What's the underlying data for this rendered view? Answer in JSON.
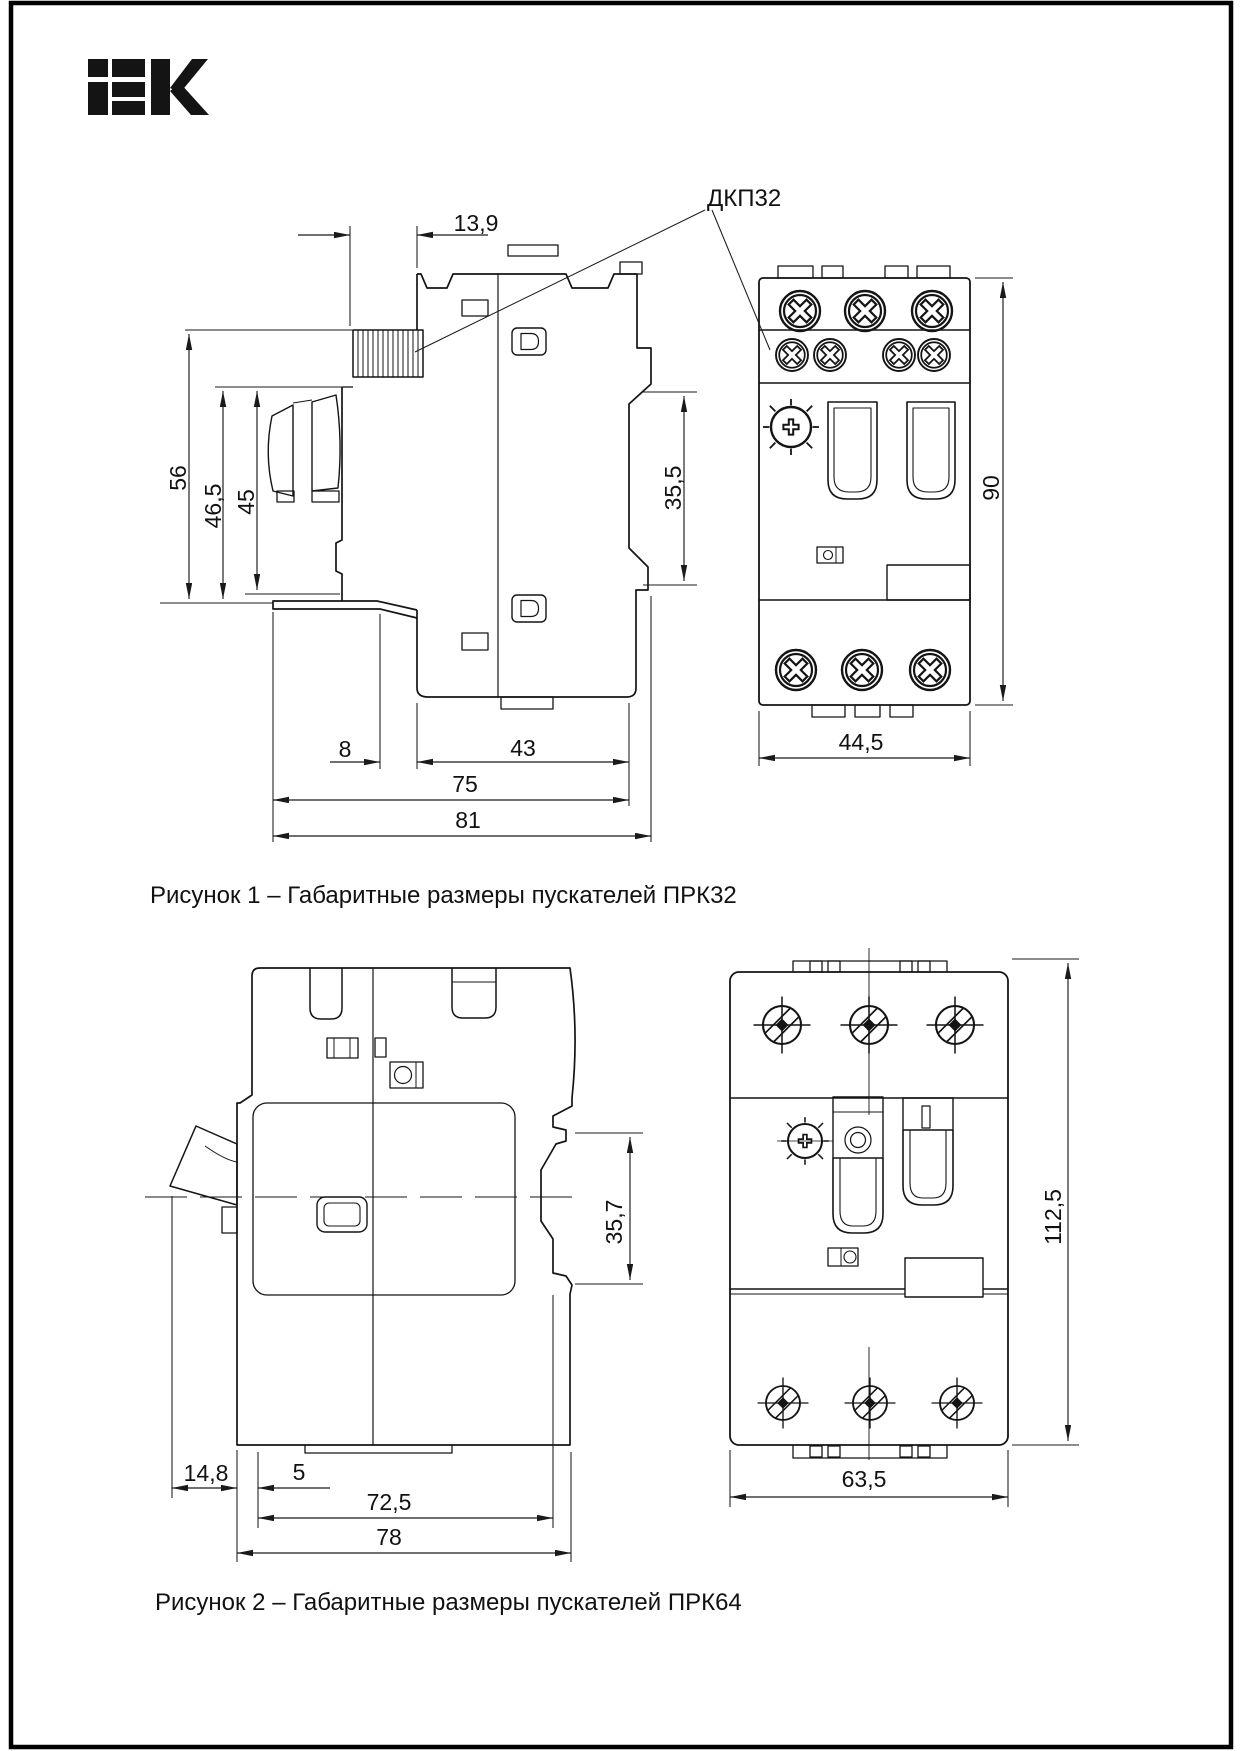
{
  "brand": {
    "logo_icon": "iek-logo",
    "logo_text": "IEK"
  },
  "figure1": {
    "part_label": "ДКП32",
    "caption": "Рисунок 1 – Габаритные размеры пускателей ПРК32",
    "dims": {
      "top_offset": "13,9",
      "height_total": "56",
      "height_mid": "46,5",
      "height_inner": "45",
      "rail_height": "35,5",
      "depth_front": "8",
      "depth_rear": "43",
      "depth_body": "75",
      "depth_total": "81",
      "front_width": "44,5",
      "front_height": "90"
    }
  },
  "figure2": {
    "caption": "Рисунок 2 – Габаритные размеры  пускателей ПРК64",
    "dims": {
      "lever_offset": "14,8",
      "foot_offset": "5",
      "depth_body": "72,5",
      "depth_total": "78",
      "rail_height": "35,7",
      "front_width": "63,5",
      "front_height": "112,5"
    }
  }
}
